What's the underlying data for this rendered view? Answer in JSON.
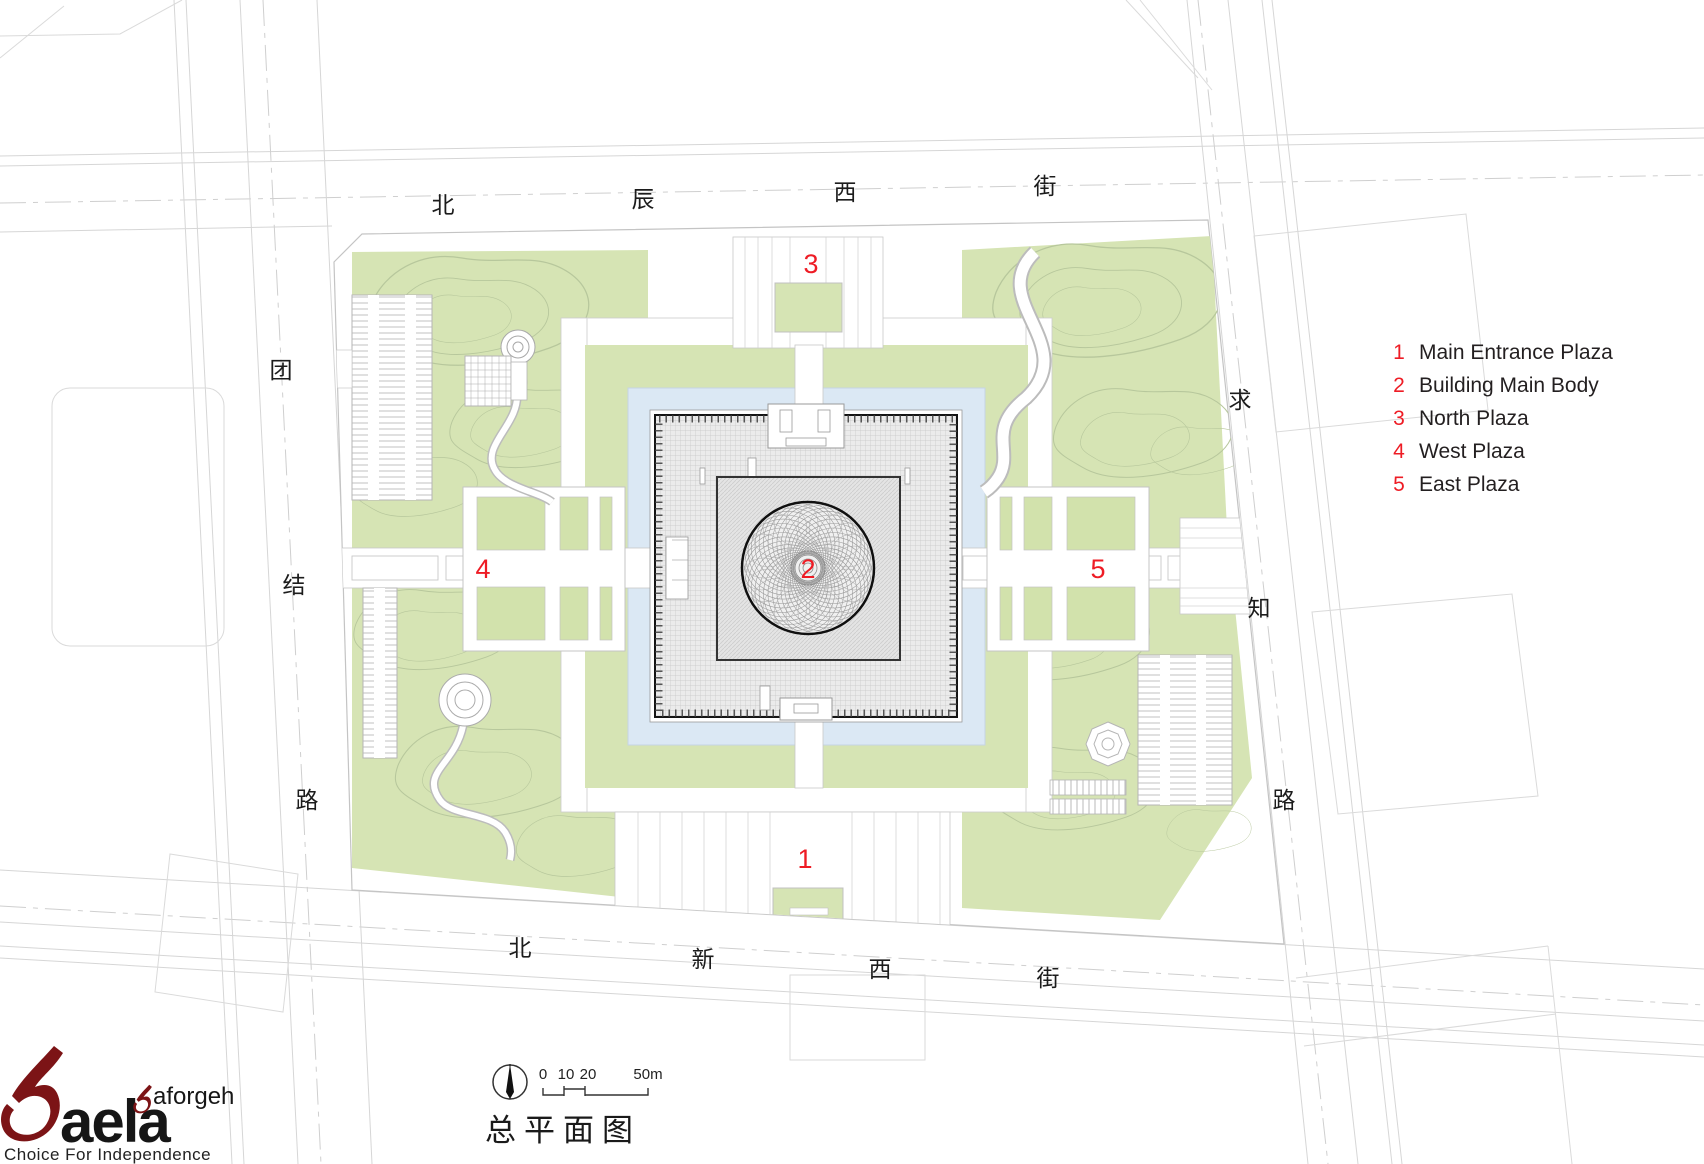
{
  "plan": {
    "title": "总平面图",
    "markers": {
      "main_entrance": "1",
      "building": "2",
      "north_plaza": "3",
      "west_plaza": "4",
      "east_plaza": "5"
    },
    "streets": {
      "top": {
        "name": "北辰西街",
        "chars": [
          "北",
          "辰",
          "西",
          "街"
        ]
      },
      "bottom": {
        "name": "北新西街",
        "chars": [
          "北",
          "新",
          "西",
          "街"
        ]
      },
      "left": {
        "name": "团结路",
        "chars": [
          "团",
          "结",
          "路"
        ]
      },
      "right": {
        "name": "求知路",
        "chars": [
          "求",
          "知",
          "路"
        ]
      }
    },
    "scale_bar": {
      "labels": [
        "0",
        "10",
        "20",
        "50m"
      ]
    }
  },
  "legend": {
    "items": [
      {
        "num": "1",
        "label": "Main Entrance Plaza"
      },
      {
        "num": "2",
        "label": "Building Main Body"
      },
      {
        "num": "3",
        "label": "North Plaza"
      },
      {
        "num": "4",
        "label": "West Plaza"
      },
      {
        "num": "5",
        "label": "East Plaza"
      }
    ]
  },
  "logo": {
    "wordmark": "aela",
    "sub": "aforgeh",
    "tagline": "Choice For Independence"
  },
  "colors": {
    "accent_red": "#ee1c25",
    "landscape_green": "#d6e4b4",
    "water_blue": "#dbe8f4",
    "logo_red": "#7c1416",
    "ink": "#231f20"
  }
}
